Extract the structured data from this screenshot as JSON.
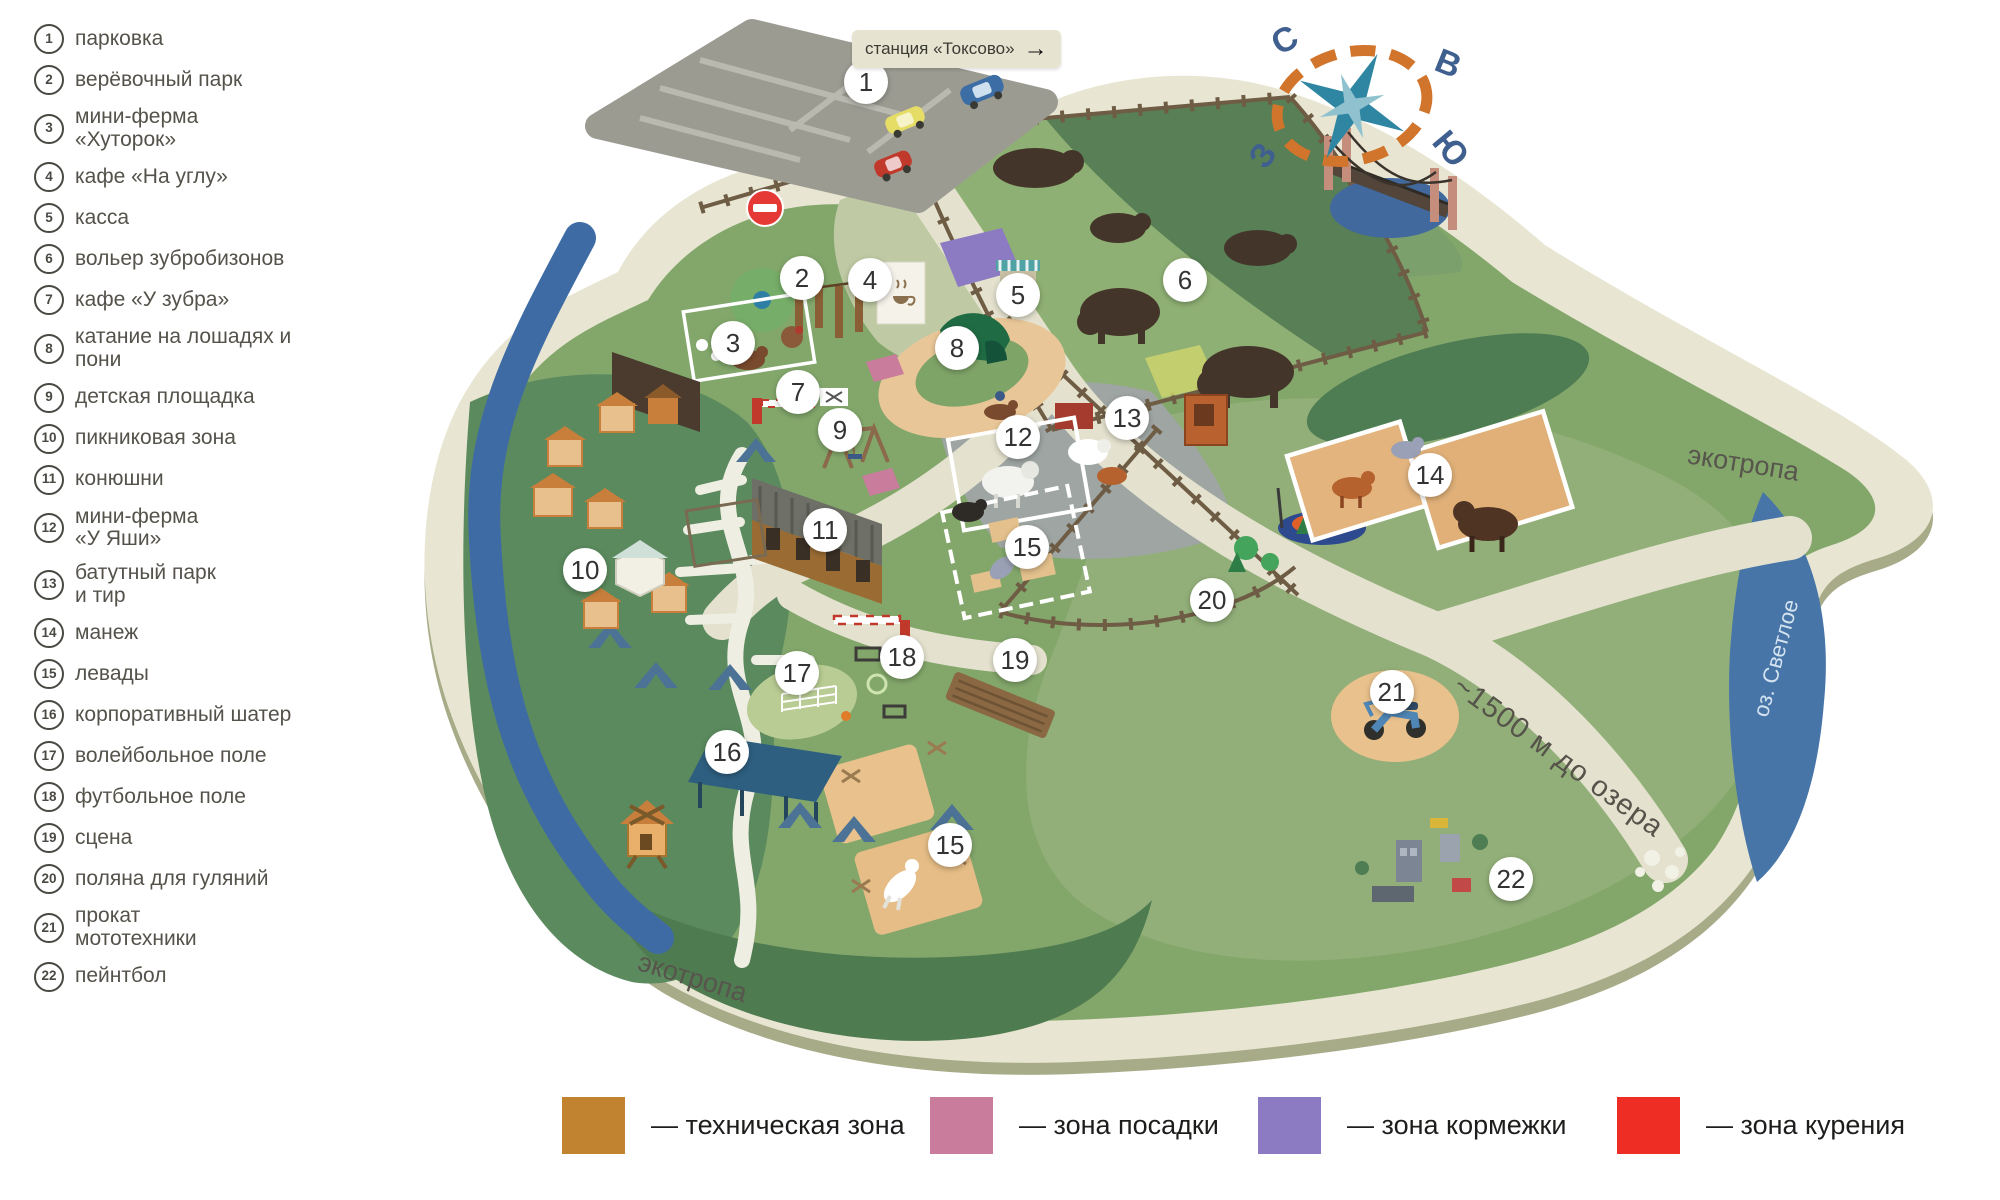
{
  "sidebar": {
    "items": [
      {
        "n": "1",
        "label": "парковка"
      },
      {
        "n": "2",
        "label": "верёвочный парк"
      },
      {
        "n": "3",
        "label": "мини-ферма\n«Хуторок»"
      },
      {
        "n": "4",
        "label": "кафе «На углу»"
      },
      {
        "n": "5",
        "label": "касса"
      },
      {
        "n": "6",
        "label": "вольер зубробизонов"
      },
      {
        "n": "7",
        "label": "кафе «У зубра»"
      },
      {
        "n": "8",
        "label": "катание на лошадях и пони"
      },
      {
        "n": "9",
        "label": "детская площадка"
      },
      {
        "n": "10",
        "label": "пикниковая зона"
      },
      {
        "n": "11",
        "label": "конюшни"
      },
      {
        "n": "12",
        "label": "мини-ферма\n«У Яши»"
      },
      {
        "n": "13",
        "label": "батутный парк\nи тир"
      },
      {
        "n": "14",
        "label": "манеж"
      },
      {
        "n": "15",
        "label": "левады"
      },
      {
        "n": "16",
        "label": "корпоративный шатер"
      },
      {
        "n": "17",
        "label": "волейбольное поле"
      },
      {
        "n": "18",
        "label": "футбольное поле"
      },
      {
        "n": "19",
        "label": "сцена"
      },
      {
        "n": "20",
        "label": "поляна для гуляний"
      },
      {
        "n": "21",
        "label": "прокат\nмототехники"
      },
      {
        "n": "22",
        "label": "пейнтбол"
      }
    ]
  },
  "map": {
    "station_sign": "станция «Токсово»",
    "station_arrow": "→",
    "labels": {
      "ecotrail_top": "экотропа",
      "ecotrail_bottom": "экотропа",
      "lake": "оз. Светлое",
      "distance": "~1500 м до озера"
    },
    "compass": {
      "north": "С",
      "east": "В",
      "west": "З",
      "south": "Ю"
    },
    "markers": [
      {
        "n": "1",
        "x": 866,
        "y": 82
      },
      {
        "n": "2",
        "x": 802,
        "y": 278
      },
      {
        "n": "3",
        "x": 733,
        "y": 343
      },
      {
        "n": "4",
        "x": 870,
        "y": 280
      },
      {
        "n": "5",
        "x": 1018,
        "y": 295
      },
      {
        "n": "6",
        "x": 1185,
        "y": 280
      },
      {
        "n": "7",
        "x": 798,
        "y": 392
      },
      {
        "n": "8",
        "x": 957,
        "y": 348
      },
      {
        "n": "9",
        "x": 840,
        "y": 430
      },
      {
        "n": "10",
        "x": 585,
        "y": 570
      },
      {
        "n": "11",
        "x": 825,
        "y": 530
      },
      {
        "n": "12",
        "x": 1018,
        "y": 437
      },
      {
        "n": "13",
        "x": 1127,
        "y": 418
      },
      {
        "n": "14",
        "x": 1430,
        "y": 475
      },
      {
        "n": "15",
        "x": 1027,
        "y": 547
      },
      {
        "n": "15",
        "x": 950,
        "y": 845
      },
      {
        "n": "16",
        "x": 727,
        "y": 752
      },
      {
        "n": "17",
        "x": 797,
        "y": 673
      },
      {
        "n": "18",
        "x": 902,
        "y": 657
      },
      {
        "n": "19",
        "x": 1015,
        "y": 660
      },
      {
        "n": "20",
        "x": 1212,
        "y": 600
      },
      {
        "n": "21",
        "x": 1392,
        "y": 692
      },
      {
        "n": "22",
        "x": 1511,
        "y": 879
      }
    ]
  },
  "zones": [
    {
      "label": "— техническая зона",
      "color": "#C28331"
    },
    {
      "label": "— зона посадки",
      "color": "#C97C9C"
    },
    {
      "label": "— зона кормежки",
      "color": "#8C7BC2"
    },
    {
      "label": "— зона курения",
      "color": "#EE2E24"
    }
  ]
}
